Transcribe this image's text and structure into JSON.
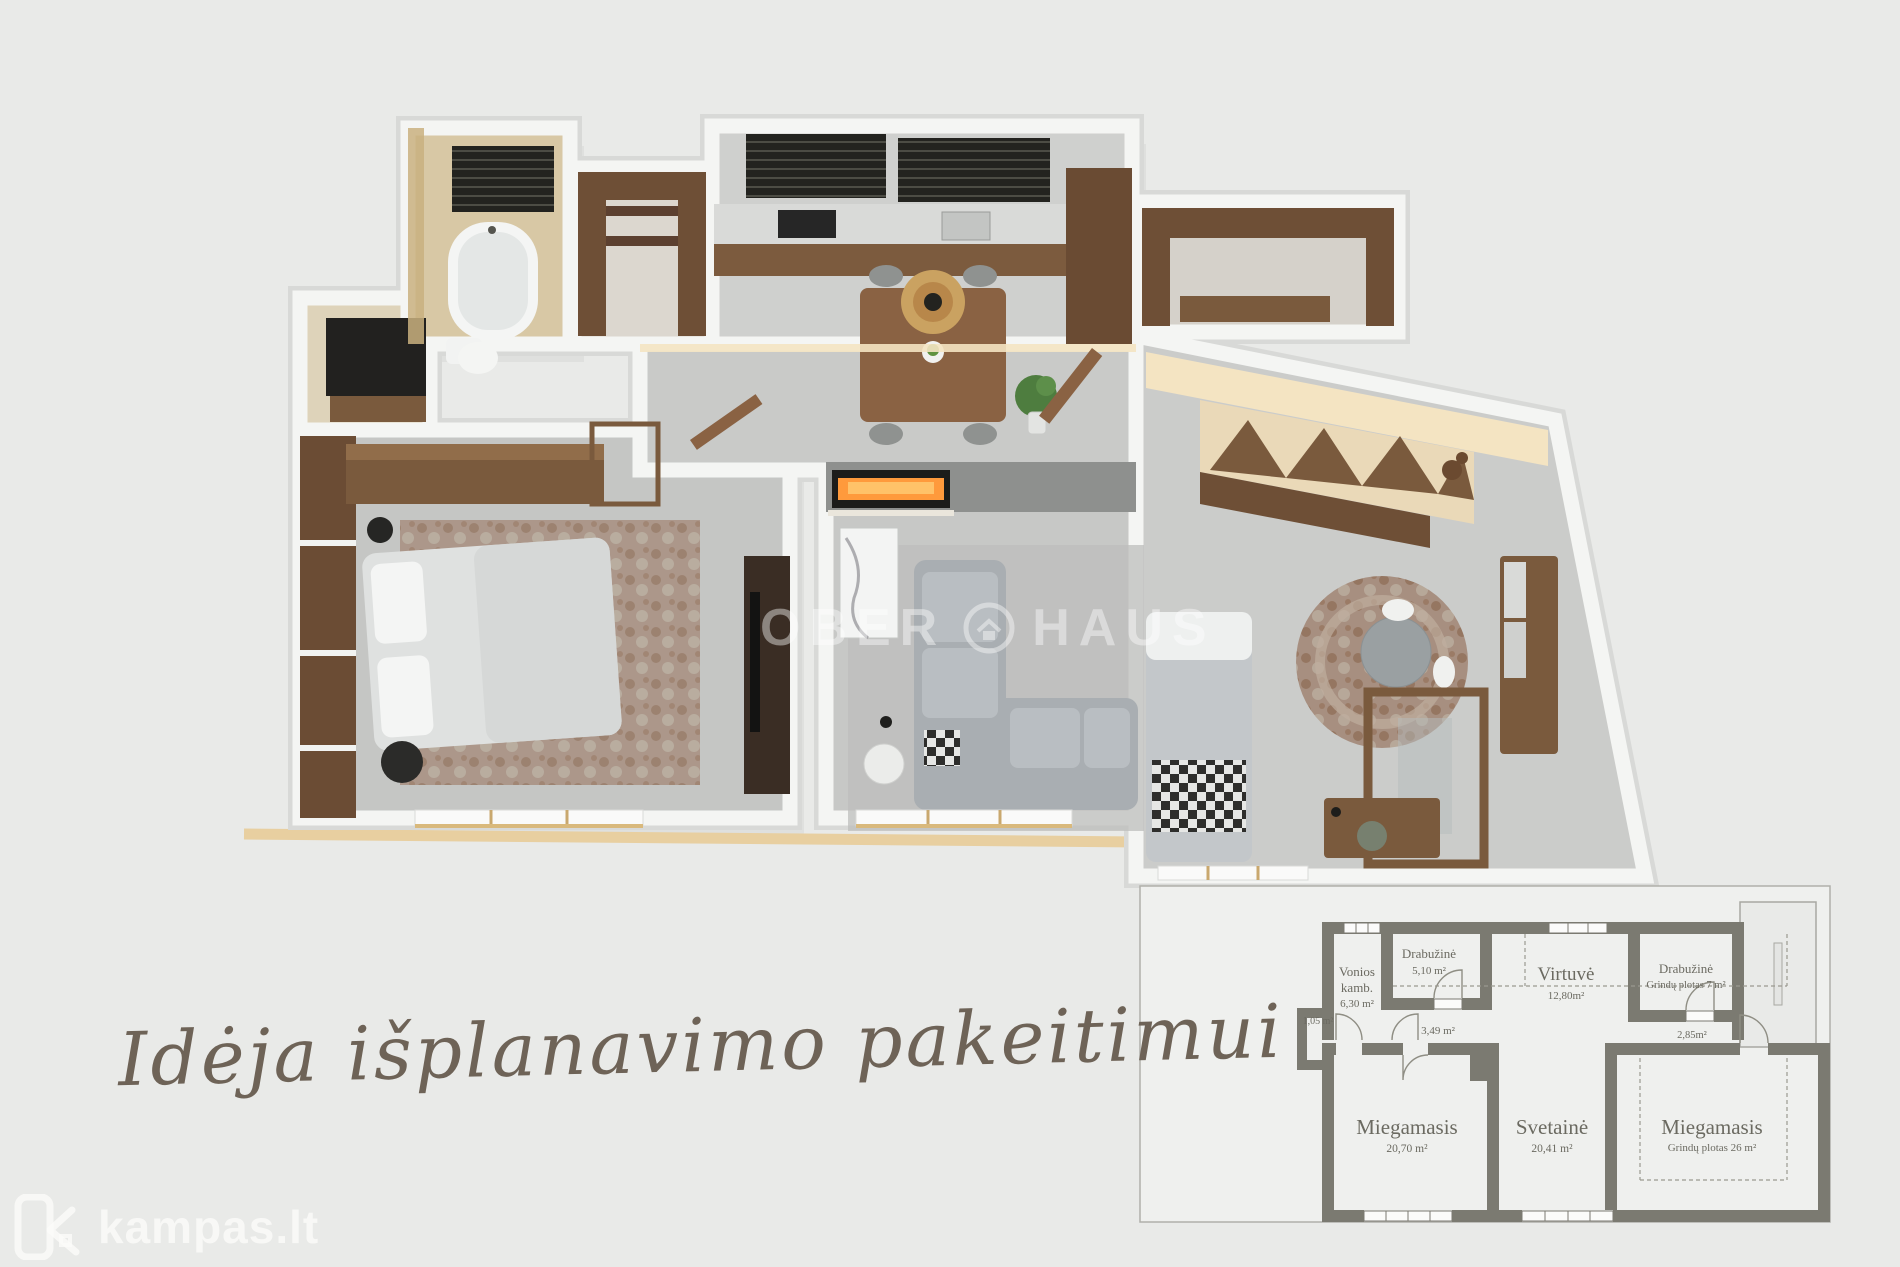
{
  "scene": {
    "background": "#e9eae8",
    "wall_white": "#f4f5f3",
    "wall_shadow": "#d8d9d7",
    "floor_gray": "#c7c8c6",
    "wood": "#7a5a3d",
    "wood_dark": "#4b3729",
    "marble_beige": "#d8c8a5",
    "fireplace_glow": "#ff9a3c",
    "plan_wall_color": "#7b7a71",
    "label_color": "#6b6a61",
    "trim_gold": "#e8cfa0"
  },
  "watermark": {
    "left": "OBER",
    "right": "HAUS"
  },
  "caption": {
    "text": "Idėja išplanavimo pakeitimui"
  },
  "brand": {
    "logo_text": "kampas.lt"
  },
  "inset_plan": {
    "rooms": [
      {
        "name": "Vonios",
        "name_line2": "kamb.",
        "area": "6,30  m²"
      },
      {
        "name": "Drabužinė",
        "area": "5,10 m²"
      },
      {
        "name": "Virtuvė",
        "area": "12,80m²"
      },
      {
        "name": "Drabužinė",
        "area": "Grindų plotas 7 m²"
      },
      {
        "name": "Miegamasis",
        "area": "20,70 m²"
      },
      {
        "name": "Svetainė",
        "area": "20,41 m²"
      },
      {
        "name": "Miegamasis",
        "area": "Grindų plotas 26 m²"
      }
    ],
    "small_areas": [
      "1,05  m²",
      "3,49  m²",
      "2,85m²"
    ]
  }
}
